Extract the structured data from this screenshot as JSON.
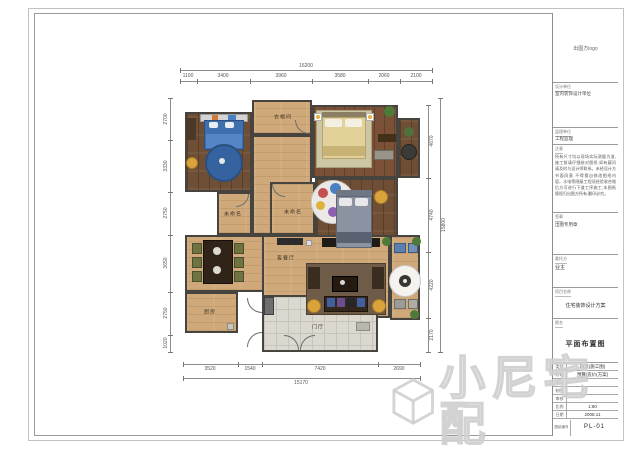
{
  "sheet": {
    "watermark_text": "小尼宅配"
  },
  "title_block": {
    "logo": "出图方logo",
    "design_unit": {
      "header": "设计单位",
      "value": "室内装饰设计单位"
    },
    "supervisor": {
      "header": "监理单位",
      "value": "工程监理"
    },
    "notes": {
      "header": "注意",
      "text": "所有尺寸均以现场实际测量为准,施工前请仔细核对图纸,如有疑问请及时与设计师联系。未经设计方书面同意,不得擅自修改图纸内容。水电等隐蔽工程须经验收合格后方可进行下道工序施工,本图纸版权归出图方所有,翻印必究。"
    },
    "seal": {
      "header": "签章",
      "value": "出图专用章"
    },
    "owner": {
      "header": "委托方",
      "value": "业主"
    },
    "project": {
      "header": "项目名称",
      "value": "住宅装饰设计方案"
    },
    "drawing": {
      "header": "图名",
      "value": "平面布置图"
    },
    "rows": [
      {
        "label": "类别",
        "value": "内装(施工图)"
      },
      {
        "label": "阶段",
        "value": "预算/造价(方案)"
      },
      {
        "label": "设计",
        "value": ""
      },
      {
        "label": "制图",
        "value": ""
      },
      {
        "label": "审核",
        "value": ""
      },
      {
        "label": "比例",
        "value": "1:80"
      },
      {
        "label": "日期",
        "value": "2008.11"
      }
    ],
    "number": {
      "label": "图纸编号",
      "value": "PL-01"
    }
  },
  "plan": {
    "rooms": {
      "cloakroom": "衣帽间",
      "room_a": "未命名",
      "room_b": "未命名",
      "living_dining": "客餐厅",
      "kitchen": "厨房",
      "entry": "门厅"
    },
    "dimensions": {
      "top_total": "16200",
      "top_segments": [
        "1100",
        "3400",
        "3960",
        "3580",
        "2060",
        "2100"
      ],
      "left_segments": [
        "2700",
        "3330",
        "2750",
        "3650",
        "2750",
        "1020"
      ],
      "right_segments": [
        "4670",
        "4740",
        "4220",
        "2170"
      ],
      "right_total": "15800",
      "bottom_segments": [
        "3520",
        "1540",
        "7420",
        "2690"
      ],
      "bottom_total": "15170"
    }
  },
  "colors": {
    "wood_dark": "#6f4e36",
    "wood_light": "#cfa97a",
    "tile": "#dbd8d0",
    "accent_blue": "#3f6fad",
    "accent_yellow": "#d9a33c"
  }
}
